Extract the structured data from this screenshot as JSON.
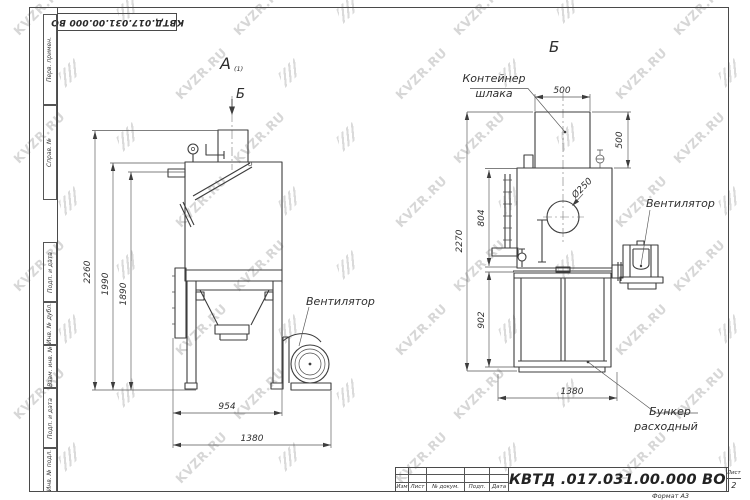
{
  "watermark": {
    "text": "KVZR.RU"
  },
  "frame": {
    "top_stamp": "КВТД.017.031.00.000  ВО",
    "left_strip": [
      {
        "label": "Перв. примен."
      },
      {
        "label": "Справ. №"
      },
      {
        "label": "Подп. и дата"
      },
      {
        "label": "Инв. № дубл."
      },
      {
        "label": "Взам. инв. №"
      },
      {
        "label": "Подп. и дата"
      },
      {
        "label": "Инв. № подл."
      }
    ]
  },
  "views": {
    "left": {
      "label": "А",
      "label_note": "(1)",
      "section_arrow": "Б",
      "fan_label": "Вентилятор",
      "dims": {
        "total_height": "2260",
        "body_top_height": "1990",
        "inner_height": "1890",
        "stand_width": "954",
        "overall_width": "1380"
      }
    },
    "right": {
      "label": "Б",
      "container_label": [
        "Контейнер",
        "шлака"
      ],
      "fan_label": "Вентилятор",
      "hopper_label": [
        "Бункер",
        "расходный"
      ],
      "dims": {
        "container_width": "500",
        "container_height": "500",
        "inlet_diameter": "Ø250",
        "total_height": "2270",
        "body_height": "804",
        "hopper_height": "902",
        "hopper_width": "1380"
      }
    }
  },
  "title_block": {
    "designation": "КВТД .017.031.00.000  ВО",
    "columns": [
      "Изм",
      "Лист",
      "№ докум.",
      "Подп.",
      "Дата"
    ],
    "sheet_label": "Лист",
    "sheet_number": "2",
    "format_note": "Формат А3"
  }
}
